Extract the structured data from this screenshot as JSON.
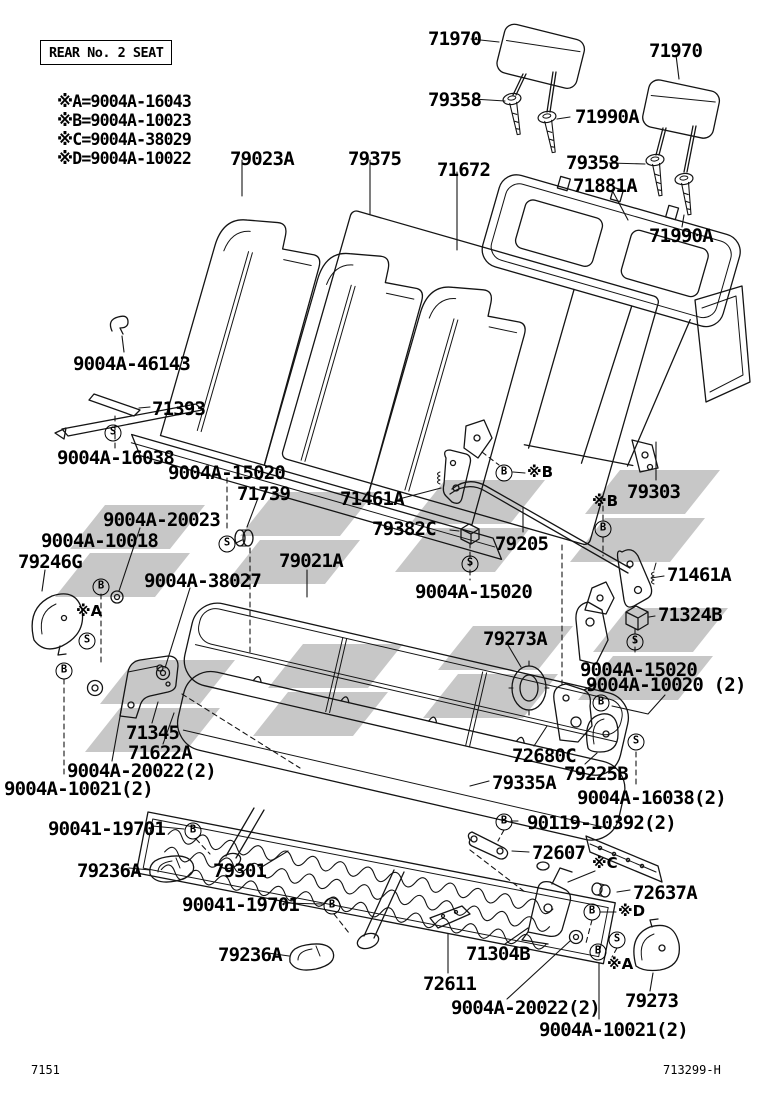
{
  "header": {
    "box_label": "REAR No. 2 SEAT"
  },
  "legend": {
    "items": [
      "※A=9004A-16043",
      "※B=9004A-10023",
      "※C=9004A-38029",
      "※D=9004A-10022"
    ]
  },
  "footer": {
    "left_code": "7151",
    "right_code": "713299-H"
  },
  "watermark_color": "#c7c7c7",
  "line_color": "#141414",
  "labels": [
    {
      "id": "79023A",
      "text": "79023A",
      "x": 230,
      "y": 150
    },
    {
      "id": "79375",
      "text": "79375",
      "x": 348,
      "y": 150
    },
    {
      "id": "71672",
      "text": "71672",
      "x": 437,
      "y": 161
    },
    {
      "id": "71970-left",
      "text": "71970",
      "x": 428,
      "y": 30
    },
    {
      "id": "79358-left",
      "text": "79358",
      "x": 428,
      "y": 91
    },
    {
      "id": "71990A-left",
      "text": "71990A",
      "x": 575,
      "y": 108
    },
    {
      "id": "71970-right",
      "text": "71970",
      "x": 649,
      "y": 42
    },
    {
      "id": "79358-right",
      "text": "79358",
      "x": 566,
      "y": 154
    },
    {
      "id": "71881A",
      "text": "71881A",
      "x": 573,
      "y": 177
    },
    {
      "id": "71990A-right",
      "text": "71990A",
      "x": 649,
      "y": 227
    },
    {
      "id": "9004A-46143",
      "text": "9004A-46143",
      "x": 73,
      "y": 355
    },
    {
      "id": "71393",
      "text": "71393",
      "x": 152,
      "y": 400
    },
    {
      "id": "9004A-16038",
      "text": "9004A-16038",
      "x": 57,
      "y": 449
    },
    {
      "id": "9004A-15020-a",
      "text": "9004A-15020",
      "x": 168,
      "y": 464
    },
    {
      "id": "71739",
      "text": "71739",
      "x": 237,
      "y": 485
    },
    {
      "id": "71461A-left",
      "text": "71461A",
      "x": 340,
      "y": 490
    },
    {
      "id": "9004A-20023",
      "text": "9004A-20023",
      "x": 103,
      "y": 511
    },
    {
      "id": "9004A-10018",
      "text": "9004A-10018",
      "x": 41,
      "y": 532
    },
    {
      "id": "79246G",
      "text": "79246G",
      "x": 18,
      "y": 553
    },
    {
      "id": "79021A",
      "text": "79021A",
      "x": 279,
      "y": 552
    },
    {
      "id": "9004A-38027",
      "text": "9004A-38027",
      "x": 144,
      "y": 572
    },
    {
      "id": "79303",
      "text": "79303",
      "x": 627,
      "y": 483
    },
    {
      "id": "79382C",
      "text": "79382C",
      "x": 372,
      "y": 520
    },
    {
      "id": "79205",
      "text": "79205",
      "x": 495,
      "y": 535
    },
    {
      "id": "9004A-15020-b",
      "text": "9004A-15020",
      "x": 415,
      "y": 583
    },
    {
      "id": "71461A-right",
      "text": "71461A",
      "x": 667,
      "y": 566
    },
    {
      "id": "71324B",
      "text": "71324B",
      "x": 658,
      "y": 606
    },
    {
      "id": "79273A",
      "text": "79273A",
      "x": 483,
      "y": 630
    },
    {
      "id": "9004A-15020-c",
      "text": "9004A-15020",
      "x": 580,
      "y": 661
    },
    {
      "id": "9004A-10020-2",
      "text": "9004A-10020 (2)",
      "x": 586,
      "y": 676
    },
    {
      "id": "71345",
      "text": "71345",
      "x": 126,
      "y": 724
    },
    {
      "id": "71622A",
      "text": "71622A",
      "x": 128,
      "y": 744
    },
    {
      "id": "9004A-20022-2-a",
      "text": "9004A-20022(2)",
      "x": 67,
      "y": 762
    },
    {
      "id": "9004A-10021-2-a",
      "text": "9004A-10021(2)",
      "x": 4,
      "y": 780
    },
    {
      "id": "72680C",
      "text": "72680C",
      "x": 512,
      "y": 747
    },
    {
      "id": "79225B",
      "text": "79225B",
      "x": 564,
      "y": 765
    },
    {
      "id": "79335A",
      "text": "79335A",
      "x": 492,
      "y": 774
    },
    {
      "id": "9004A-16038-2",
      "text": "9004A-16038(2)",
      "x": 577,
      "y": 789
    },
    {
      "id": "90041-19701-a",
      "text": "90041-19701",
      "x": 48,
      "y": 820
    },
    {
      "id": "90119-10392-2",
      "text": "90119-10392(2)",
      "x": 527,
      "y": 814
    },
    {
      "id": "79236A-a",
      "text": "79236A",
      "x": 77,
      "y": 862
    },
    {
      "id": "79301",
      "text": "79301",
      "x": 213,
      "y": 862
    },
    {
      "id": "72607",
      "text": "72607",
      "x": 532,
      "y": 844
    },
    {
      "id": "90041-19701-b",
      "text": "90041-19701",
      "x": 182,
      "y": 896
    },
    {
      "id": "72637A",
      "text": "72637A",
      "x": 633,
      "y": 884
    },
    {
      "id": "79236A-b",
      "text": "79236A",
      "x": 218,
      "y": 946
    },
    {
      "id": "71304B",
      "text": "71304B",
      "x": 466,
      "y": 945
    },
    {
      "id": "72611",
      "text": "72611",
      "x": 423,
      "y": 975
    },
    {
      "id": "79273",
      "text": "79273",
      "x": 625,
      "y": 992
    },
    {
      "id": "9004A-20022-2-b",
      "text": "9004A-20022(2)",
      "x": 451,
      "y": 999
    },
    {
      "id": "9004A-10021-2-b",
      "text": "9004A-10021(2)",
      "x": 539,
      "y": 1021
    }
  ],
  "symbols": [
    {
      "kind": "circle",
      "letter": "S",
      "x": 113,
      "y": 433
    },
    {
      "kind": "circle",
      "letter": "S",
      "x": 227,
      "y": 544
    },
    {
      "kind": "circle",
      "letter": "S",
      "x": 87,
      "y": 641
    },
    {
      "kind": "circle",
      "letter": "S",
      "x": 470,
      "y": 564
    },
    {
      "kind": "circle",
      "letter": "S",
      "x": 635,
      "y": 642
    },
    {
      "kind": "circle",
      "letter": "S",
      "x": 636,
      "y": 742
    },
    {
      "kind": "circle",
      "letter": "S",
      "x": 617,
      "y": 940
    },
    {
      "kind": "circle",
      "letter": "B",
      "x": 101,
      "y": 587
    },
    {
      "kind": "circle",
      "letter": "B",
      "x": 64,
      "y": 671
    },
    {
      "kind": "circle",
      "letter": "B",
      "x": 504,
      "y": 473
    },
    {
      "kind": "circle",
      "letter": "B",
      "x": 603,
      "y": 529
    },
    {
      "kind": "circle",
      "letter": "B",
      "x": 601,
      "y": 703
    },
    {
      "kind": "circle",
      "letter": "B",
      "x": 193,
      "y": 831
    },
    {
      "kind": "circle",
      "letter": "B",
      "x": 332,
      "y": 906
    },
    {
      "kind": "circle",
      "letter": "B",
      "x": 504,
      "y": 822
    },
    {
      "kind": "circle",
      "letter": "B",
      "x": 592,
      "y": 912
    },
    {
      "kind": "circle",
      "letter": "B",
      "x": 598,
      "y": 952
    },
    {
      "kind": "ref",
      "text": "※B",
      "x": 527,
      "y": 465
    },
    {
      "kind": "ref",
      "text": "※B",
      "x": 592,
      "y": 494
    },
    {
      "kind": "ref",
      "text": "※A",
      "x": 76,
      "y": 604
    },
    {
      "kind": "ref",
      "text": "※C",
      "x": 592,
      "y": 856
    },
    {
      "kind": "ref",
      "text": "※D",
      "x": 618,
      "y": 904
    },
    {
      "kind": "ref",
      "text": "※A",
      "x": 607,
      "y": 957
    }
  ]
}
